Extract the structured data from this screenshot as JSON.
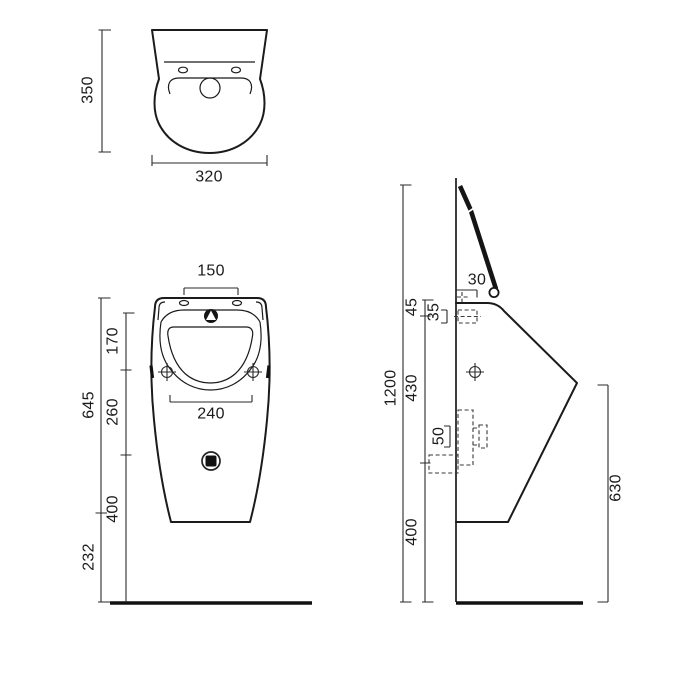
{
  "title": "urinal-technical-drawing",
  "colors": {
    "line": "#1b1b1b",
    "dashed_detail": "#3a3a3a",
    "background": "#ffffff"
  },
  "top_view": {
    "labels": {
      "height": "350",
      "width": "320"
    }
  },
  "front_view": {
    "labels": {
      "inlet_spacing": "150",
      "rim_to_holes": "170",
      "holes_to_drain": "260",
      "overall_height": "645",
      "bowl_width": "240",
      "drain_to_floor": "400",
      "bottom_to_floor": "232"
    }
  },
  "side_view": {
    "labels": {
      "inlet_offset": "30",
      "rim_to_inlet": "45",
      "inlet_depth": "35",
      "overall_height": "1200",
      "rim_to_outlet": "430",
      "outlet_size": "50",
      "bottom_to_floor": "400",
      "front_edge_height": "630"
    }
  }
}
